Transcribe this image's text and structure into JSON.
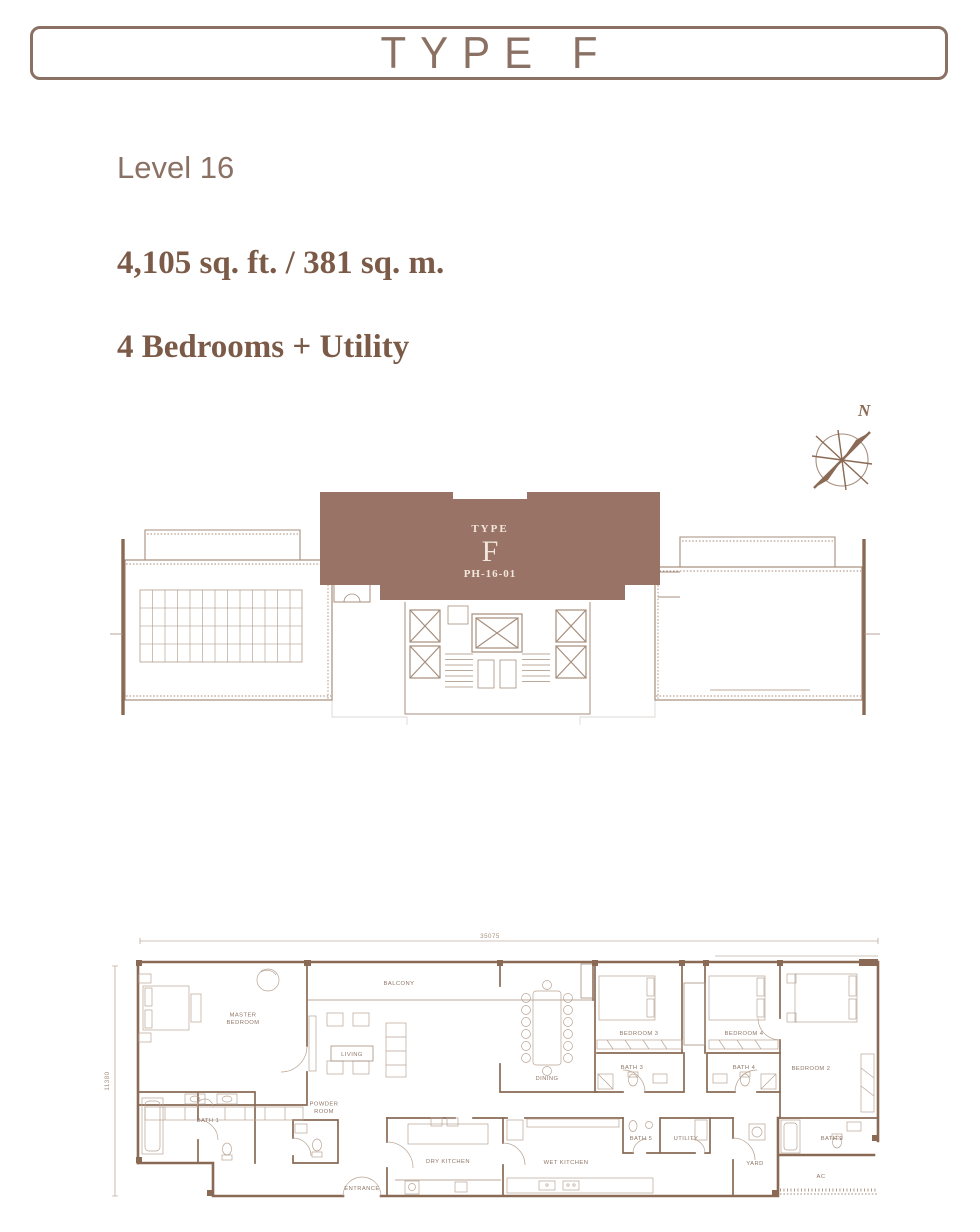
{
  "header": {
    "title": "TYPE F"
  },
  "unit": {
    "level": "Level 16",
    "area": "4,105 sq. ft. / 381 sq. m.",
    "bedrooms": "4 Bedrooms + Utility"
  },
  "key_plan": {
    "type_caption": "TYPE",
    "type_letter": "F",
    "unit_number": "PH-16-01"
  },
  "compass": {
    "north_label": "N"
  },
  "floor_plan": {
    "dim_width": "35075",
    "dim_height": "11380",
    "rooms": [
      {
        "id": "master_bedroom",
        "label": "MASTER BEDROOM"
      },
      {
        "id": "balcony",
        "label": "BALCONY"
      },
      {
        "id": "living",
        "label": "LIVING"
      },
      {
        "id": "dining",
        "label": "DINING"
      },
      {
        "id": "bedroom3",
        "label": "BEDROOM 3"
      },
      {
        "id": "bedroom4",
        "label": "BEDROOM 4"
      },
      {
        "id": "bedroom2",
        "label": "BEDROOM 2"
      },
      {
        "id": "bath1",
        "label": "BATH 1"
      },
      {
        "id": "bath3",
        "label": "BATH 3"
      },
      {
        "id": "bath4",
        "label": "BATH 4"
      },
      {
        "id": "bath5",
        "label": "BATH 5"
      },
      {
        "id": "bath2",
        "label": "BATH 2"
      },
      {
        "id": "powder_room",
        "label": "POWDER ROOM"
      },
      {
        "id": "dry_kitchen",
        "label": "DRY KITCHEN"
      },
      {
        "id": "wet_kitchen",
        "label": "WET KITCHEN"
      },
      {
        "id": "utility",
        "label": "UTILITY"
      },
      {
        "id": "yard",
        "label": "YARD"
      },
      {
        "id": "ac",
        "label": "AC"
      },
      {
        "id": "entrance",
        "label": "ENTRANCE"
      }
    ]
  },
  "colors": {
    "accent_brown": "#8a7164",
    "bold_text_brown": "#7b5a47",
    "wall_brown": "#8a6a55",
    "block_fill": "#997365",
    "block_text_cream": "#f2e7dd"
  }
}
